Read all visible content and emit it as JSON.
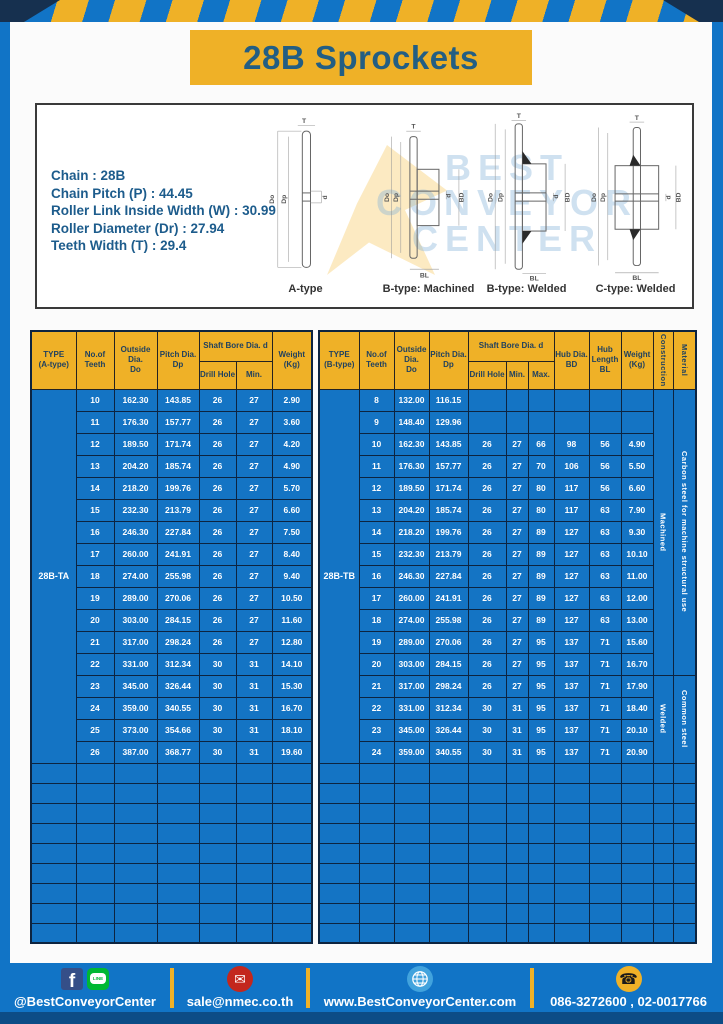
{
  "title": "28B Sprockets",
  "specs": {
    "lines": [
      "Chain  : 28B",
      "Chain Pitch (P)  : 44.45",
      "Roller Link Inside Width (W)  : 30.99",
      "Roller Diameter (Dr)  : 27.94",
      "Teeth Width (T)  : 29.4"
    ]
  },
  "drawings": {
    "captions": [
      "A-type",
      "B-type: Machined",
      "B-type: Welded",
      "C-type: Welded"
    ],
    "labels": {
      "t": "T",
      "douter": "Do",
      "dp": "Dp",
      "d": "d",
      "bd": "BD",
      "bl": "BL"
    }
  },
  "watermark": {
    "lines": [
      "BEST",
      "CONVEYOR",
      "CENTER"
    ]
  },
  "left_table": {
    "type_label": "28B-TA",
    "header": {
      "type": "TYPE\n(A-type)",
      "teeth": "No.of\nTeeth",
      "outside": "Outside\nDia.\nDo",
      "pitch": "Pitch Dia.\nDp",
      "shaft_bore": "Shaft Bore Dia. d",
      "drill": "Drill Hole",
      "min": "Min.",
      "weight": "Weight\n(Kg)"
    },
    "rows": [
      [
        "10",
        "162.30",
        "143.85",
        "26",
        "27",
        "2.90"
      ],
      [
        "11",
        "176.30",
        "157.77",
        "26",
        "27",
        "3.60"
      ],
      [
        "12",
        "189.50",
        "171.74",
        "26",
        "27",
        "4.20"
      ],
      [
        "13",
        "204.20",
        "185.74",
        "26",
        "27",
        "4.90"
      ],
      [
        "14",
        "218.20",
        "199.76",
        "26",
        "27",
        "5.70"
      ],
      [
        "15",
        "232.30",
        "213.79",
        "26",
        "27",
        "6.60"
      ],
      [
        "16",
        "246.30",
        "227.84",
        "26",
        "27",
        "7.50"
      ],
      [
        "17",
        "260.00",
        "241.91",
        "26",
        "27",
        "8.40"
      ],
      [
        "18",
        "274.00",
        "255.98",
        "26",
        "27",
        "9.40"
      ],
      [
        "19",
        "289.00",
        "270.06",
        "26",
        "27",
        "10.50"
      ],
      [
        "20",
        "303.00",
        "284.15",
        "26",
        "27",
        "11.60"
      ],
      [
        "21",
        "317.00",
        "298.24",
        "26",
        "27",
        "12.80"
      ],
      [
        "22",
        "331.00",
        "312.34",
        "30",
        "31",
        "14.10"
      ],
      [
        "23",
        "345.00",
        "326.44",
        "30",
        "31",
        "15.30"
      ],
      [
        "24",
        "359.00",
        "340.55",
        "30",
        "31",
        "16.70"
      ],
      [
        "25",
        "373.00",
        "354.66",
        "30",
        "31",
        "18.10"
      ],
      [
        "26",
        "387.00",
        "368.77",
        "30",
        "31",
        "19.60"
      ]
    ],
    "empty_row_count": 9
  },
  "right_table": {
    "type_label": "28B-TB",
    "header": {
      "type": "TYPE\n(B-type)",
      "teeth": "No.of\nTeeth",
      "outside": "Outside\nDia.\nDo",
      "pitch": "Pitch Dia.\nDp",
      "shaft_bore": "Shaft Bore Dia. d",
      "drill": "Drill Hole",
      "min": "Min.",
      "max": "Max.",
      "hub_dia": "Hub Dia.\nBD",
      "hub_len": "Hub\nLength\nBL",
      "weight": "Weight\n(Kg)",
      "construction": "Construction",
      "material": "Material"
    },
    "rows": [
      [
        "8",
        "132.00",
        "116.15",
        "",
        "",
        "",
        "",
        "",
        ""
      ],
      [
        "9",
        "148.40",
        "129.96",
        "",
        "",
        "",
        "",
        "",
        ""
      ],
      [
        "10",
        "162.30",
        "143.85",
        "26",
        "27",
        "66",
        "98",
        "56",
        "4.90"
      ],
      [
        "11",
        "176.30",
        "157.77",
        "26",
        "27",
        "70",
        "106",
        "56",
        "5.50"
      ],
      [
        "12",
        "189.50",
        "171.74",
        "26",
        "27",
        "80",
        "117",
        "56",
        "6.60"
      ],
      [
        "13",
        "204.20",
        "185.74",
        "26",
        "27",
        "80",
        "117",
        "63",
        "7.90"
      ],
      [
        "14",
        "218.20",
        "199.76",
        "26",
        "27",
        "89",
        "127",
        "63",
        "9.30"
      ],
      [
        "15",
        "232.30",
        "213.79",
        "26",
        "27",
        "89",
        "127",
        "63",
        "10.10"
      ],
      [
        "16",
        "246.30",
        "227.84",
        "26",
        "27",
        "89",
        "127",
        "63",
        "11.00"
      ],
      [
        "17",
        "260.00",
        "241.91",
        "26",
        "27",
        "89",
        "127",
        "63",
        "12.00"
      ],
      [
        "18",
        "274.00",
        "255.98",
        "26",
        "27",
        "89",
        "127",
        "63",
        "13.00"
      ],
      [
        "19",
        "289.00",
        "270.06",
        "26",
        "27",
        "95",
        "137",
        "71",
        "15.60"
      ],
      [
        "20",
        "303.00",
        "284.15",
        "26",
        "27",
        "95",
        "137",
        "71",
        "16.70"
      ],
      [
        "21",
        "317.00",
        "298.24",
        "26",
        "27",
        "95",
        "137",
        "71",
        "17.90"
      ],
      [
        "22",
        "331.00",
        "312.34",
        "30",
        "31",
        "95",
        "137",
        "71",
        "18.40"
      ],
      [
        "23",
        "345.00",
        "326.44",
        "30",
        "31",
        "95",
        "137",
        "71",
        "20.10"
      ],
      [
        "24",
        "359.00",
        "340.55",
        "30",
        "31",
        "95",
        "137",
        "71",
        "20.90"
      ]
    ],
    "construction_groups": [
      {
        "label": "Machined",
        "span": 13
      },
      {
        "label": "Welded",
        "span": 4
      }
    ],
    "material_groups": [
      {
        "label": "Carbon steel for machine structural use",
        "span": 13
      },
      {
        "label": "Common steel",
        "span": 4
      }
    ],
    "empty_row_count": 9
  },
  "footer": {
    "facebook_letter": "f",
    "line_text": "LINE",
    "mail_glyph": "✉",
    "phone_glyph": "☎",
    "social_label": "@BestConveyorCenter",
    "email": "sale@nmec.co.th",
    "website": "www.BestConveyorCenter.com",
    "phones": "086-3272600 , 02-0017766"
  },
  "colors": {
    "page_blue": "#1174c6",
    "table_blue": "#1474c4",
    "accent_yellow": "#efb127",
    "title_navy": "#235e83",
    "border_dark": "#0d2440",
    "mail_red": "#c3271d",
    "line_green": "#00b833",
    "facebook_navy": "#354f88",
    "globe_blue": "#41a3dd",
    "bottom_strip_blue": "#0c4c86"
  }
}
